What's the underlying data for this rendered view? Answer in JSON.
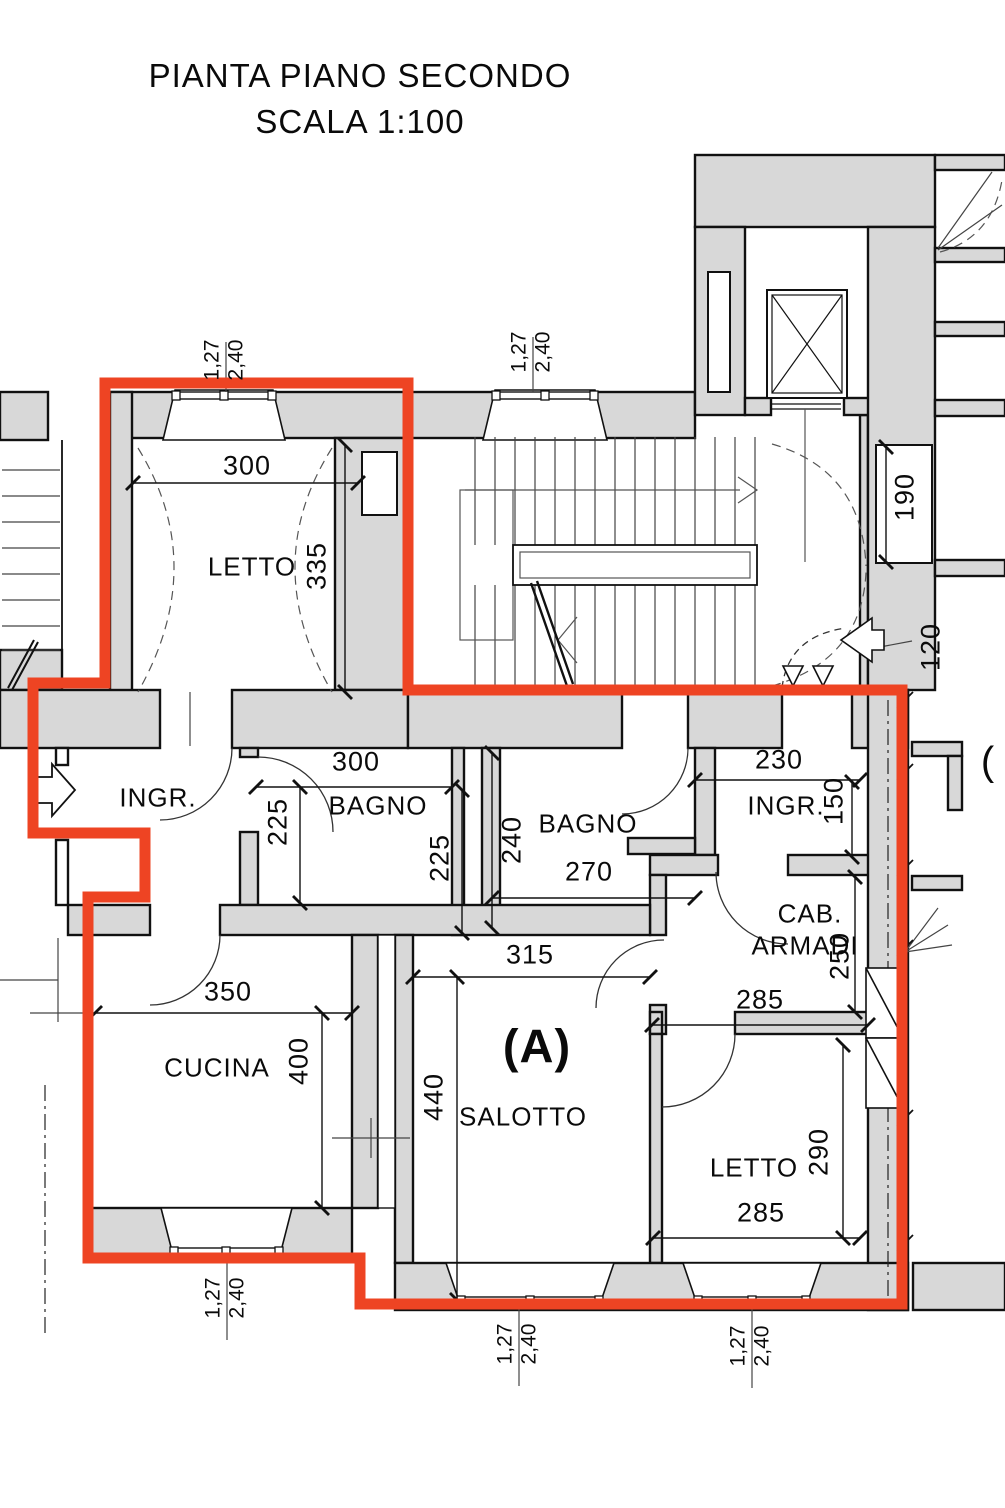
{
  "title": {
    "line1": "PIANTA PIANO SECONDO",
    "line2": "SCALA 1:100"
  },
  "apartment": {
    "unit_label": "(A)",
    "adjacent_partial_label": "("
  },
  "rooms": {
    "letto_nord": {
      "label": "LETTO",
      "w": "300",
      "h": "335"
    },
    "ingresso_ovest": {
      "label": "INGR."
    },
    "bagno_1": {
      "label": "BAGNO",
      "w": "300",
      "h": "225",
      "h2": "225"
    },
    "bagno_2": {
      "label": "BAGNO",
      "w": "270",
      "h": "240"
    },
    "ingresso_est": {
      "label": "INGR.",
      "w": "230",
      "h": "150"
    },
    "cabina_armadi": {
      "label_line1": "CAB.",
      "label_line2": "ARMADI",
      "w": "285",
      "h": "250"
    },
    "cucina": {
      "label": "CUCINA",
      "w": "350",
      "h": "400"
    },
    "salotto": {
      "label": "SALOTTO",
      "w": "315",
      "h": "440"
    },
    "letto_sud": {
      "label": "LETTO",
      "w": "285",
      "h": "290"
    }
  },
  "common_dims": {
    "niche_190": "190",
    "landing_120": "120"
  },
  "window_dims": {
    "width": "1,27",
    "height": "2,40"
  },
  "colors": {
    "boundary_red": "#ee4423",
    "wall_gray": "#d8d8d8",
    "line_black": "#111111"
  }
}
